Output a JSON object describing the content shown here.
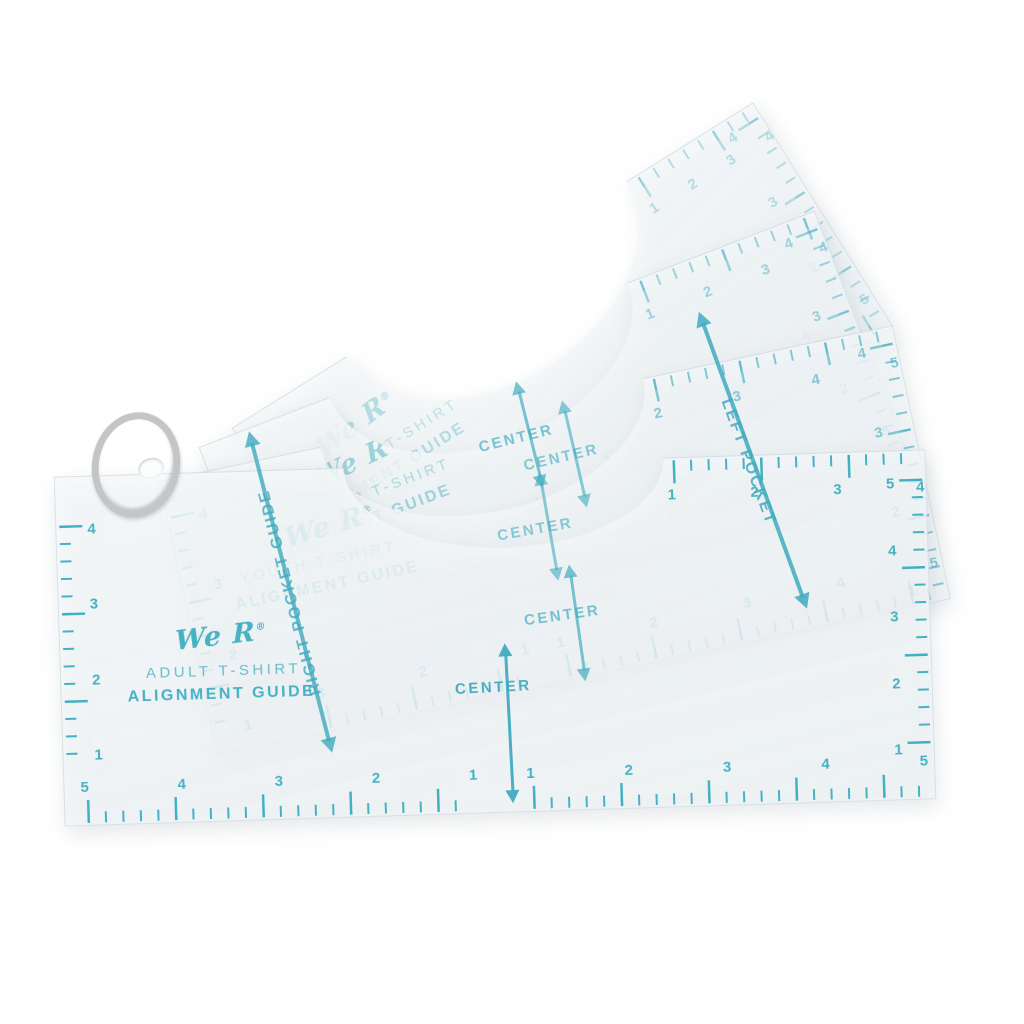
{
  "scene": {
    "description": "Product photo: set of four translucent t-shirt alignment guide rulers fanned out on a metal binder ring",
    "background_color": "#ffffff",
    "ink_color": "#4db4c6",
    "sheet_color": "#f4f8f9",
    "ring_color": "#c3c5c7"
  },
  "sheets": [
    {
      "brand": "We R",
      "reg": "®",
      "title": "TODDLER T-SHIRT",
      "subtitle": "ALIGNMENT GUIDE",
      "scales": {
        "top": [
          "1",
          "2",
          "3",
          "4"
        ],
        "right": [
          "4",
          "3",
          "2",
          "1"
        ],
        "bottom_left": [
          "3",
          "2",
          "1"
        ],
        "bottom_right": [
          "1",
          "2",
          "3",
          "4",
          "5"
        ]
      }
    },
    {
      "brand": "We R",
      "reg": "®",
      "title": "TODDLER T-SHIRT",
      "subtitle": "ALIGNMENT GUIDE",
      "scales": {
        "top": [
          "1",
          "2",
          "3",
          "4"
        ],
        "right": [
          "4",
          "3",
          "2",
          "1"
        ],
        "bottom_left": [
          "3",
          "2",
          "1"
        ],
        "bottom_right": [
          "1",
          "2",
          "3",
          "4",
          "5"
        ]
      }
    },
    {
      "brand": "We R",
      "reg": "®",
      "title": "YOUTH T-SHIRT",
      "subtitle": "ALIGNMENT GUIDE",
      "scales": {
        "top": [
          "2",
          "3",
          "4",
          "5"
        ],
        "right": [
          "4",
          "3",
          "2",
          "1"
        ],
        "left": [
          "4",
          "3",
          "2",
          "1"
        ],
        "bottom_left": [
          "3",
          "2",
          "1"
        ],
        "bottom_right": [
          "1",
          "2",
          "3",
          "4",
          "5"
        ]
      }
    },
    {
      "brand": "We R",
      "reg": "®",
      "title": "ADULT T-SHIRT",
      "subtitle": "ALIGNMENT GUIDE",
      "scales": {
        "top": [
          "1",
          "2",
          "3",
          "4"
        ],
        "right": [
          "5",
          "4",
          "3",
          "2",
          "1"
        ],
        "left": [
          "4",
          "3",
          "2",
          "1"
        ],
        "bottom_left": [
          "5",
          "4",
          "3",
          "2",
          "1"
        ],
        "bottom_right": [
          "1",
          "2",
          "3",
          "4",
          "5"
        ]
      }
    }
  ],
  "overlays": {
    "centers": [
      {
        "text": "CENTER"
      },
      {
        "text": "CENTER"
      },
      {
        "text": "CENTER"
      },
      {
        "text": "CENTER"
      },
      {
        "text": "CENTER"
      }
    ],
    "right_pocket_label": "RIGHT POCKET GUIDE",
    "left_pocket_label": "LEFT POCKET"
  }
}
